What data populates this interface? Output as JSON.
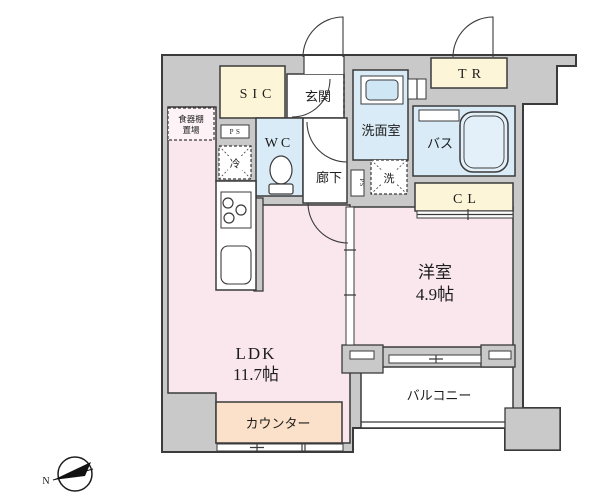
{
  "compass": {
    "north_label": "N"
  },
  "rooms": {
    "sic": {
      "label": "SIC"
    },
    "genkan": {
      "label": "玄関"
    },
    "tr": {
      "label": "TR"
    },
    "senmen": {
      "label": "洗面室"
    },
    "bath": {
      "label": "バス"
    },
    "wc": {
      "label": "WC"
    },
    "hallway": {
      "label": "廊下"
    },
    "cl": {
      "label": "CL"
    },
    "western_room": {
      "label": "洋室",
      "size": "4.9帖"
    },
    "ldk": {
      "label": "LDK",
      "size": "11.7帖"
    },
    "counter": {
      "label": "カウンター"
    },
    "balcony": {
      "label": "バルコニー"
    }
  },
  "fixtures": {
    "dish_shelf": {
      "line1": "食器棚",
      "line2": "置場"
    },
    "refrigerator": {
      "label": "冷"
    },
    "washer": {
      "label": "洗"
    },
    "ps_top": {
      "label": "PS"
    },
    "ps_side": {
      "label": "PS"
    }
  },
  "colors": {
    "wall_fill": "#c9c9c9",
    "wall_stroke": "#3b3b3b",
    "room_pink": "#fae7ee",
    "room_blue": "#d9ebf7",
    "closet_cream": "#fcf5d8",
    "counter_peach": "#fbe1c9",
    "tub_blue": "#e3f0f9"
  }
}
